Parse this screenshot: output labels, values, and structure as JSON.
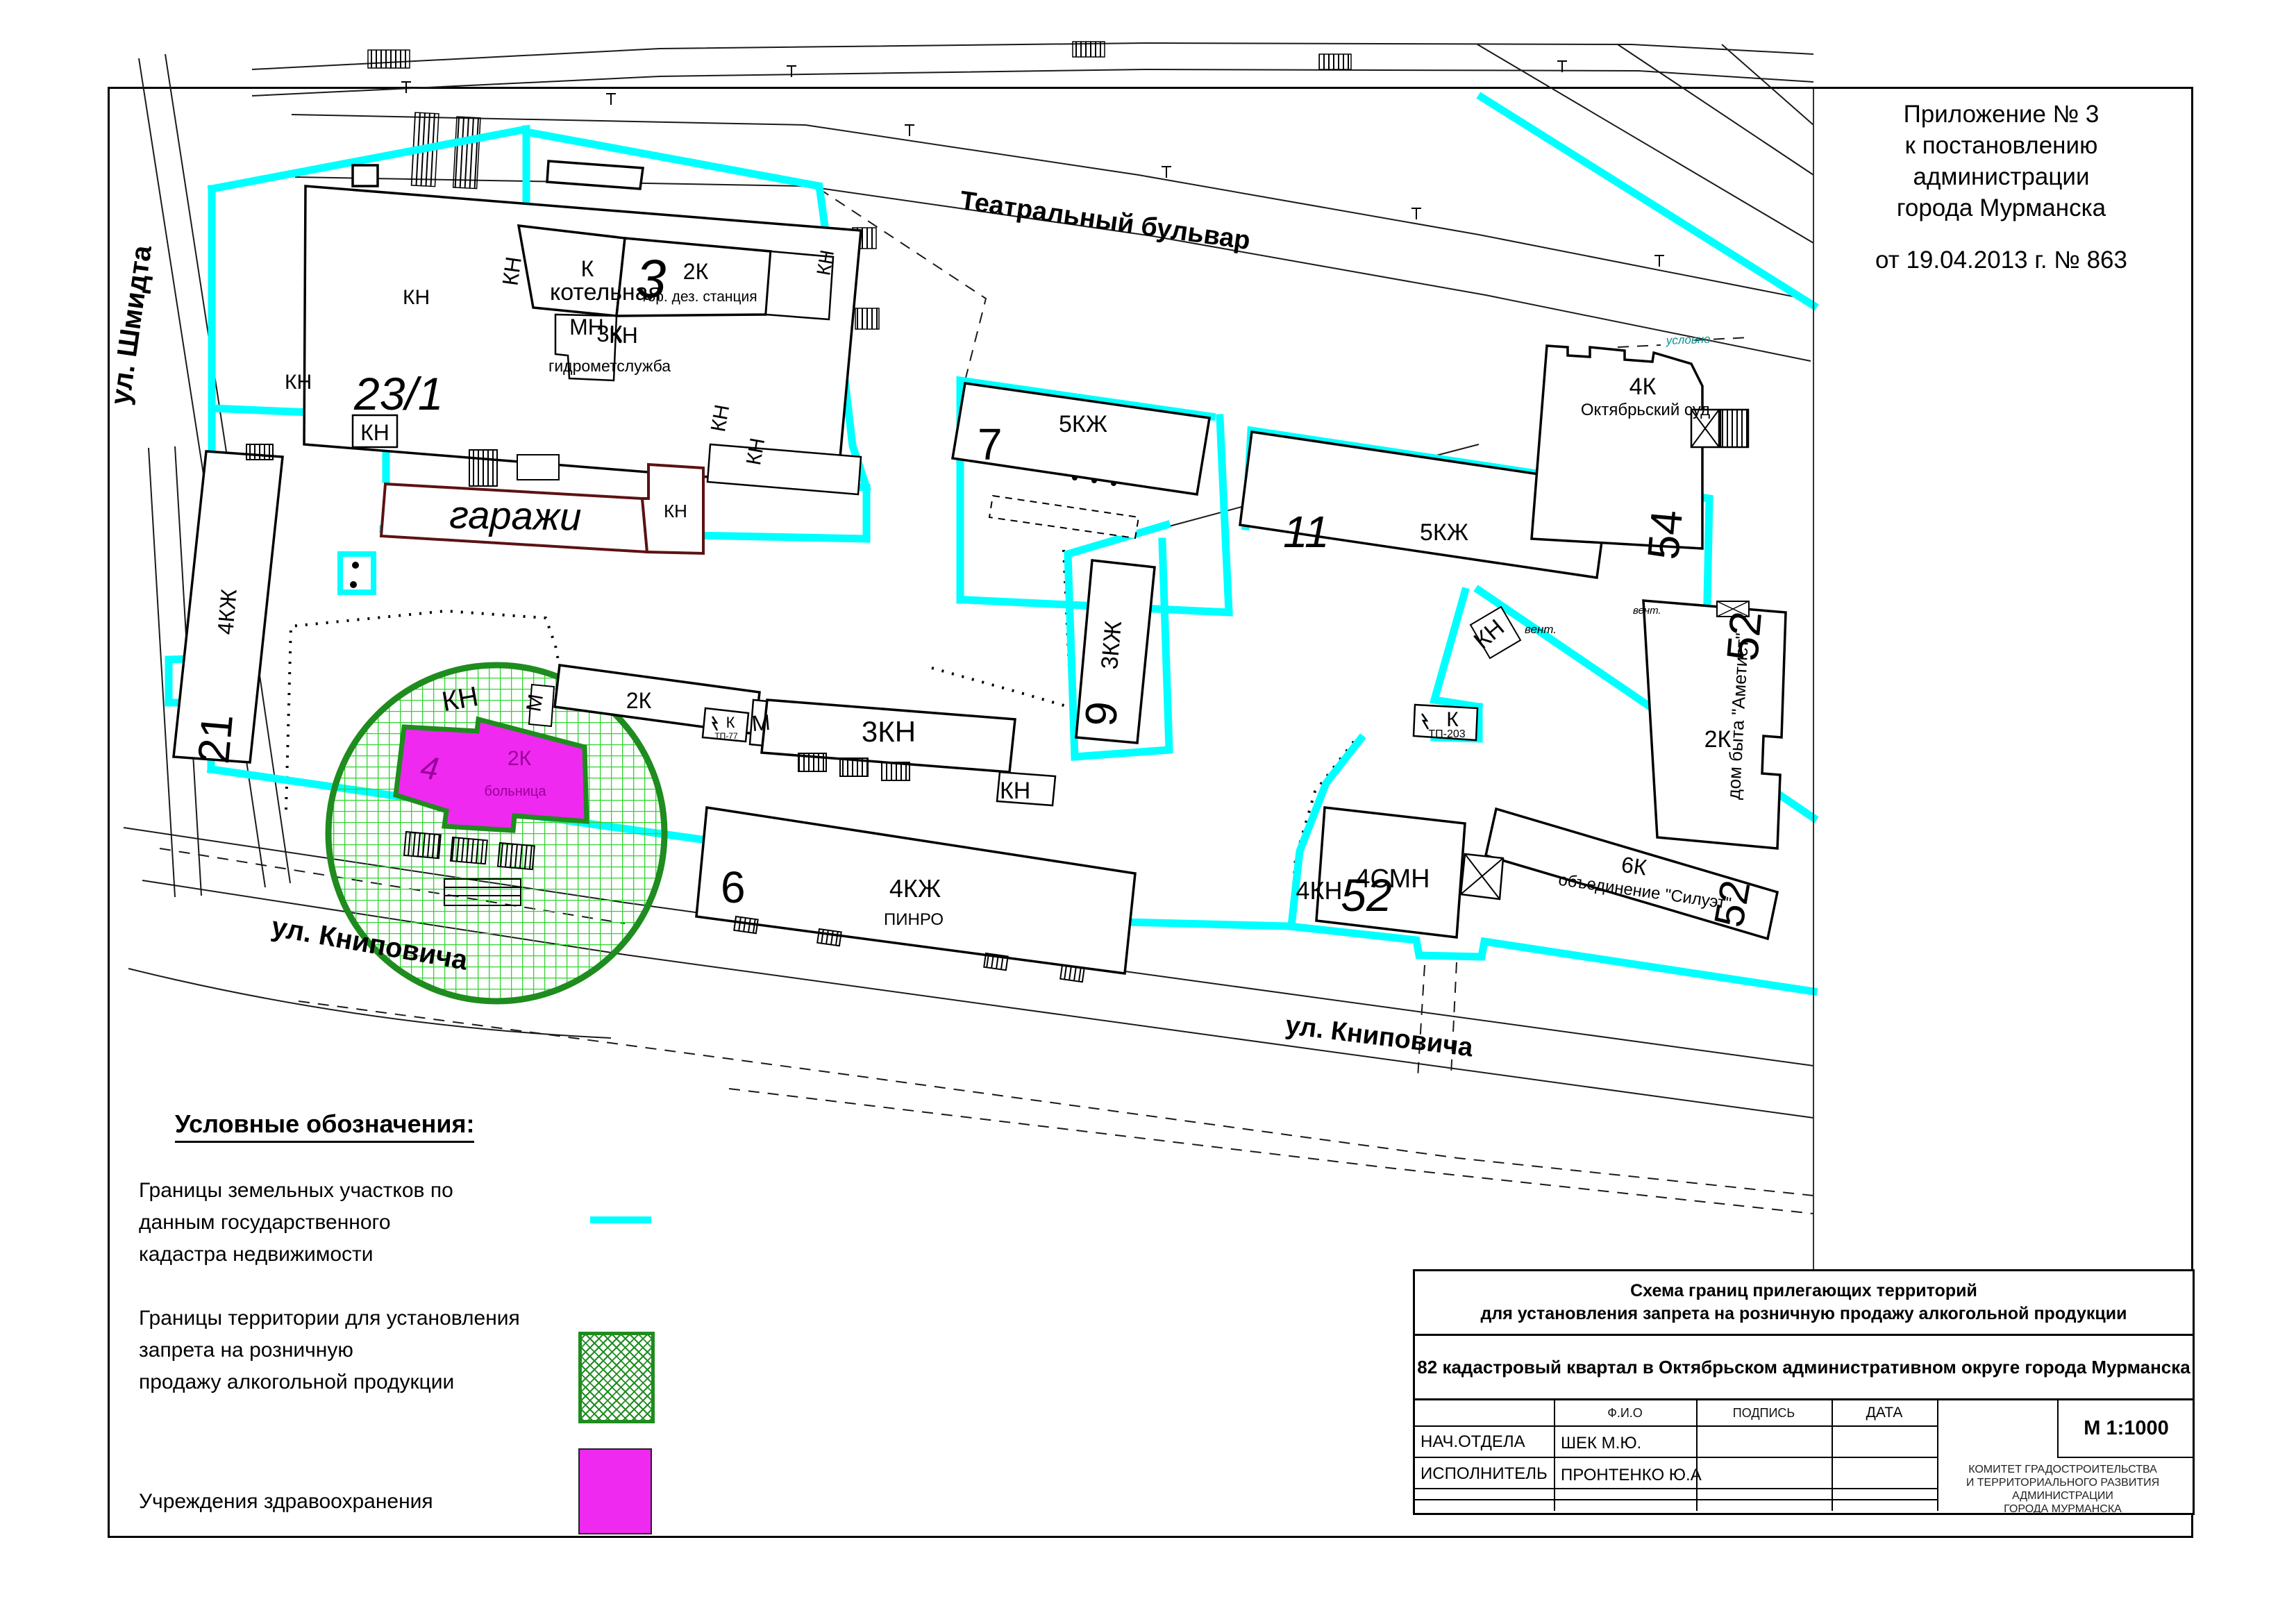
{
  "annotation": {
    "line1": "Приложение № 3",
    "line2": "к постановлению администрации",
    "line3": "города Мурманска",
    "date_line": "от 19.04.2013 г. № 863"
  },
  "legend": {
    "title": "Условные обозначения:",
    "item1": [
      "Границы земельных участков по",
      "данным государственного",
      "кадастра недвижимости"
    ],
    "item2": [
      "Границы территории для установления",
      "запрета на розничную",
      "продажу алкогольной продукции"
    ],
    "item3": "Учреждения здравоохранения"
  },
  "title_block": {
    "title1": "Схема границ прилегающих территорий",
    "title2": "для установления запрета на розничную продажу алкогольной продукции",
    "quarter": "82 кадастровый квартал в Октябрьском административном округе города Мурманска",
    "col_fio": "Ф.И.О",
    "col_podpis": "ПОДПИСЬ",
    "col_data": "ДАТА",
    "row1_role": "НАЧ.ОТДЕЛА",
    "row1_name": "ШЕК М.Ю.",
    "row2_role": "ИСПОЛНИТЕЛЬ",
    "row2_name": "ПРОНТЕНКО Ю.А",
    "scale": "М 1:1000",
    "committee": [
      "КОМИТЕТ ГРАДОСТРОИТЕЛЬСТВА",
      "И ТЕРРИТОРИАЛЬНОГО РАЗВИТИЯ",
      "АДМИНИСТРАЦИИ",
      "ГОРОДА МУРМАНСКА"
    ]
  },
  "map": {
    "streets": {
      "shmidta": "ул. Шмидта",
      "teatralny": "Театральный бульвар",
      "knipovicha": "ул. Книповича"
    },
    "labels": {
      "kn": "КН",
      "mn": "МН",
      "m": "М",
      "k": "К",
      "vent": "вент.",
      "uslovno": "условно",
      "tp77": "ТП-77",
      "tp203": "ТП-203"
    },
    "buildings": {
      "gidromet": {
        "num": "23/1",
        "type": "3К",
        "name": "гидрометслужба"
      },
      "kotelnaya": {
        "num": "3",
        "type": "К",
        "name": "котельная"
      },
      "dez": {
        "type": "2К",
        "name": "гор. дез. станция"
      },
      "b7": {
        "num": "7",
        "type": "5КЖ"
      },
      "b11": {
        "num": "11",
        "type": "5КЖ"
      },
      "sud": {
        "num": "54",
        "type": "4К",
        "name": "Октябрьский суд"
      },
      "b21": {
        "num": "21",
        "type": "4КЖ"
      },
      "garages": {
        "name": "гаражи"
      },
      "b2k": {
        "type": "2К"
      },
      "b9": {
        "num": "9",
        "type": "3КЖ"
      },
      "b3kn": {
        "type": "3КН"
      },
      "pinro": {
        "num": "6",
        "type": "4КЖ",
        "name": "ПИНРО"
      },
      "hospital": {
        "num": "4",
        "type": "2К",
        "name": "больница"
      },
      "ametist": {
        "num": "52",
        "type": "2К",
        "name": "дом быта \"Аметист\""
      },
      "siluet": {
        "num": "52",
        "type": "6К",
        "name": "объединение \"Силуэт\""
      },
      "smn": {
        "num": "52",
        "type": "4СМН",
        "extra": "4КН"
      }
    },
    "colors": {
      "cadastral": "#00ffff",
      "territory_border": "#1e8c1e",
      "territory_grid": "#2fd42f",
      "health": "#ef29ef",
      "garage_outline": "#5c1212"
    }
  }
}
